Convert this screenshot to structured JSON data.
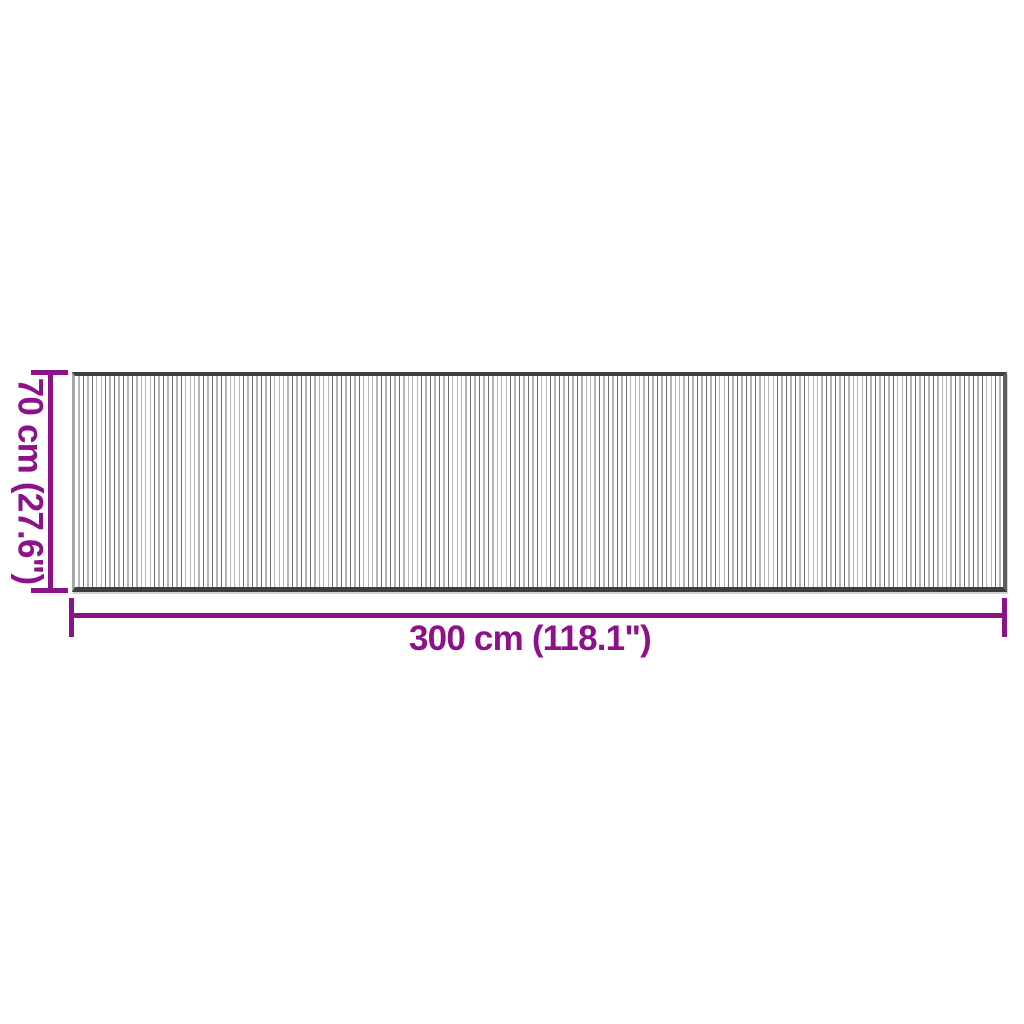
{
  "diagram": {
    "type": "product-dimension-diagram",
    "subject": "striped rug, top view",
    "accent_color": "#8d1188",
    "height_dimension": {
      "label": "70 cm (27.6\")"
    },
    "width_dimension": {
      "label": "300 cm (118.1\")"
    },
    "rug": {
      "background": "#ffffff",
      "stripe_color": "#6d6d6d",
      "rail_color": "#3e3e3e",
      "edge_left_color": "#a6a6a6",
      "edge_right_color": "#5f5f5f"
    }
  }
}
